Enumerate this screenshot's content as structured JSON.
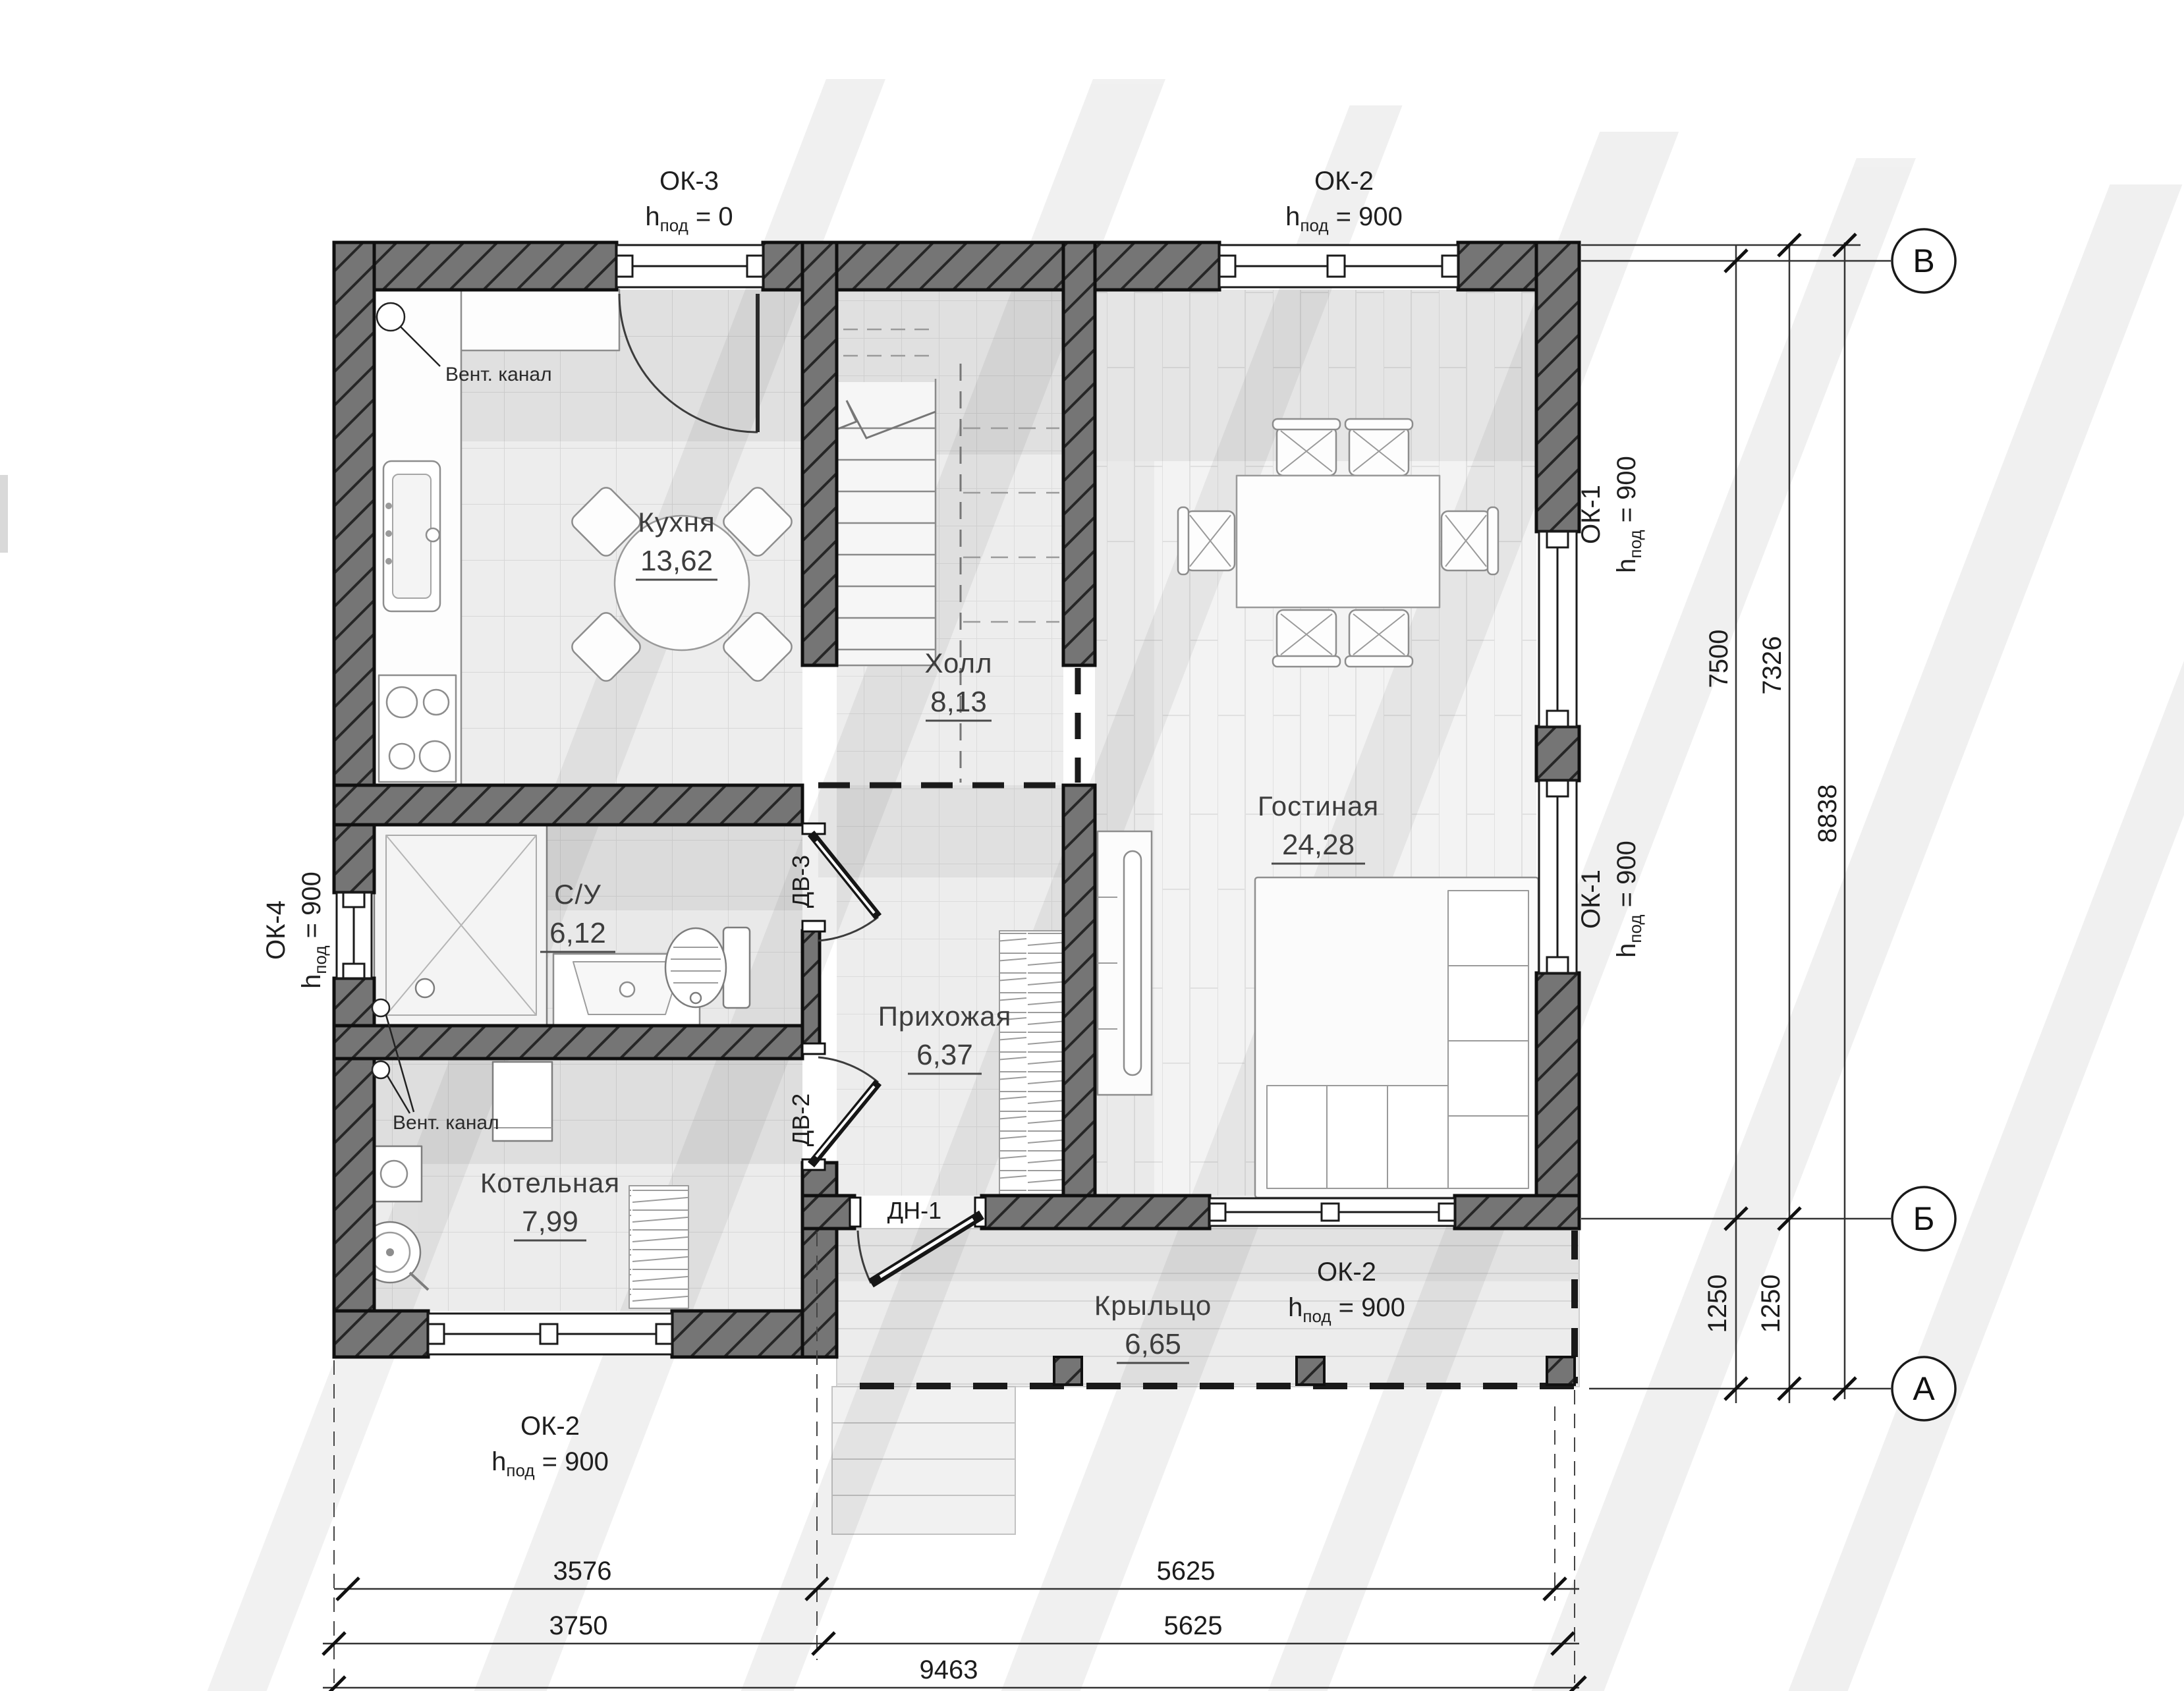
{
  "plan": {
    "rooms": {
      "kitchen": {
        "name": "Кухня",
        "area": "13,62"
      },
      "hall": {
        "name": "Холл",
        "area": "8,13"
      },
      "living": {
        "name": "Гостиная",
        "area": "24,28"
      },
      "bathroom": {
        "name": "С/У",
        "area": "6,12"
      },
      "entry": {
        "name": "Прихожая",
        "area": "6,37"
      },
      "boiler": {
        "name": "Котельная",
        "area": "7,99"
      },
      "porch": {
        "name": "Крыльцо",
        "area": "6,65"
      }
    },
    "windows": {
      "ok3": {
        "name": "ОК-3",
        "h": "h",
        "sub": "под",
        "val": " = 0"
      },
      "ok2_top": {
        "name": "ОК-2",
        "h": "h",
        "sub": "под",
        "val": " = 900"
      },
      "ok1_upper": {
        "name": "ОК-1",
        "h": "h",
        "sub": "под",
        "val": " = 900"
      },
      "ok1_lower": {
        "name": "ОК-1",
        "h": "h",
        "sub": "под",
        "val": " = 900"
      },
      "ok4": {
        "name": "ОК-4",
        "h": "h",
        "sub": "под",
        "val": " = 900"
      },
      "ok2_porch": {
        "name": "ОК-2",
        "h": "h",
        "sub": "под",
        "val": " = 900"
      },
      "ok2_boiler": {
        "name": "ОК-2",
        "h": "h",
        "sub": "под",
        "val": " = 900"
      }
    },
    "doors": {
      "dn1": "ДН-1",
      "dv2": "ДВ-2",
      "dv3": "ДВ-3"
    },
    "notes": {
      "vent_kitchen": "Вент. канал",
      "vent_boiler": "Вент. канал"
    },
    "axes": {
      "v": "В",
      "b": "Б",
      "a": "А"
    },
    "dims": {
      "h_right_1": "7500",
      "h_right_2": "7326",
      "h_right_total": "8838",
      "porch_1": "1250",
      "porch_2": "1250",
      "bottom_1a": "3576",
      "bottom_1b": "5625",
      "bottom_2a": "3750",
      "bottom_2b": "5625",
      "bottom_total": "9463"
    }
  }
}
